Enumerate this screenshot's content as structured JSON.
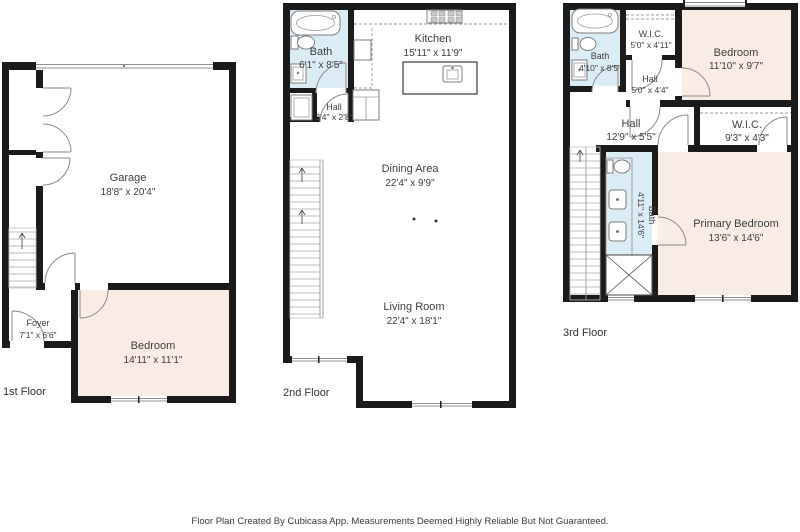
{
  "document": {
    "type": "floor-plan",
    "footer": "Floor Plan Created By Cubicasa App. Measurements Deemed Highly Reliable But Not Guaranteed."
  },
  "colors": {
    "wall": "#1b1b1b",
    "bedroom_fill": "#f8ece5",
    "bath_fill": "#dcecf5",
    "line": "#8a8a8a",
    "text": "#3d3d3d",
    "background": "#ffffff"
  },
  "floors": [
    {
      "label": "1st Floor",
      "rooms": [
        {
          "name": "Garage",
          "dims": "18'8\" x 20'4\""
        },
        {
          "name": "Foyer",
          "dims": "7'1\" x 6'6\""
        },
        {
          "name": "Bedroom",
          "dims": "14'11\" x 11'1\""
        }
      ]
    },
    {
      "label": "2nd Floor",
      "rooms": [
        {
          "name": "Bath",
          "dims": "6'1\" x 8'5\""
        },
        {
          "name": "Kitchen",
          "dims": "15'11\" x 11'9\""
        },
        {
          "name": "Hall",
          "dims": "3'4\" x 2'8\""
        },
        {
          "name": "Dining Area",
          "dims": "22'4\" x 9'9\""
        },
        {
          "name": "Living Room",
          "dims": "22'4\" x 18'1\""
        }
      ]
    },
    {
      "label": "3rd Floor",
      "rooms": [
        {
          "name": "Bath",
          "dims": "4'10\" x 8'5\""
        },
        {
          "name": "W.I.C.",
          "dims": "5'0\" x 4'11\""
        },
        {
          "name": "Hall",
          "dims": "5'0\" x 4'4\""
        },
        {
          "name": "Bedroom",
          "dims": "11'10\" x 9'7\""
        },
        {
          "name": "Hall",
          "dims": "12'9\" x 5'5\""
        },
        {
          "name": "W.I.C.",
          "dims": "9'3\" x 4'3\""
        },
        {
          "name": "Bath",
          "dims": "4'11\" x 14'6\""
        },
        {
          "name": "Primary Bedroom",
          "dims": "13'6\" x 14'6\""
        }
      ]
    }
  ]
}
